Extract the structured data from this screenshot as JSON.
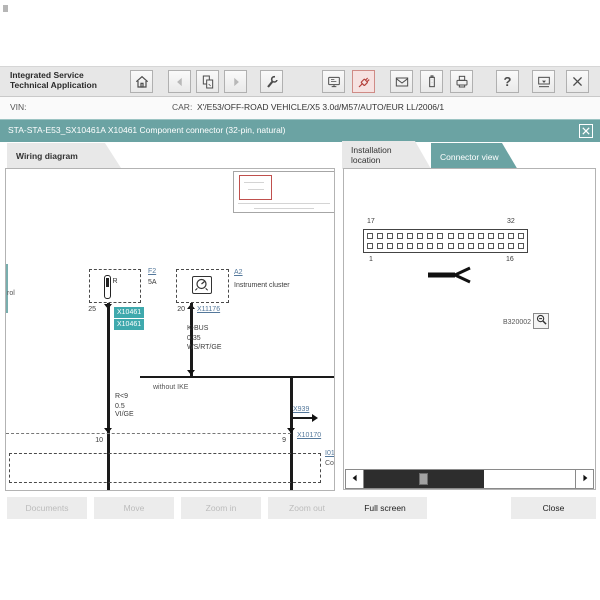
{
  "header": {
    "app_title_line1": "Integrated Service",
    "app_title_line2": "Technical Application",
    "help_glyph": "?",
    "toolbar_icons": [
      "home",
      "back",
      "documents",
      "forward",
      "tools",
      "control-unit",
      "connector",
      "mail",
      "battery",
      "print",
      "help",
      "minimize",
      "close"
    ]
  },
  "vehicle_bar": {
    "vin_label": "VIN:",
    "vin_value": "",
    "car_label": "CAR:",
    "car_value": "X'/E53/OFF-ROAD VEHICLE/X5 3.0d/M57/AUTO/EUR LL/2006/1"
  },
  "document_bar": {
    "title": "STA-STA-E53_SX10461A X10461 Component connector (32-pin, natural)"
  },
  "wiring_panel": {
    "tab_label": "Wiring diagram",
    "clipped_word_left": "rol",
    "fuse": {
      "terminal": "R",
      "ref": "F2",
      "rating": "5A",
      "pin": "25"
    },
    "selected_connector": {
      "tag_top": "X10461",
      "tag_bottom": "X10461"
    },
    "cluster": {
      "ref": "A2",
      "name": "Instrument cluster",
      "pin": "20",
      "connector": "X11176"
    },
    "bus_wire": {
      "name": "K-BUS",
      "cross_section": "0.35",
      "color": "WS/RT/GE"
    },
    "note": "without IKE",
    "left_wire": {
      "name": "R<9",
      "cross_section": "0.5",
      "color": "VI/GE"
    },
    "branch_ref": "X939",
    "bottom": {
      "pin_left": "10",
      "pin_right": "9",
      "connector_ref": "X10170",
      "clipped_ref": "I01",
      "clipped_word": "Co"
    }
  },
  "connector_panel": {
    "tab_installation": "Installation location",
    "tab_connector": "Connector view",
    "connector": {
      "rows": 2,
      "cols": 16,
      "pin_top_left": "17",
      "pin_top_right": "32",
      "pin_bottom_left": "1",
      "pin_bottom_right": "16"
    },
    "figure_code": "B320002"
  },
  "footer": {
    "documents": "Documents",
    "move": "Move",
    "zoom_in": "Zoom in",
    "zoom_out": "Zoom out",
    "full_screen": "Full screen",
    "close": "Close"
  },
  "colors": {
    "accent_teal": "#6ba3a3",
    "highlight_teal": "#3fa9ad",
    "alert_red": "#b5413c",
    "viewport_red": "#c0504d",
    "link_blue": "#54789b"
  }
}
